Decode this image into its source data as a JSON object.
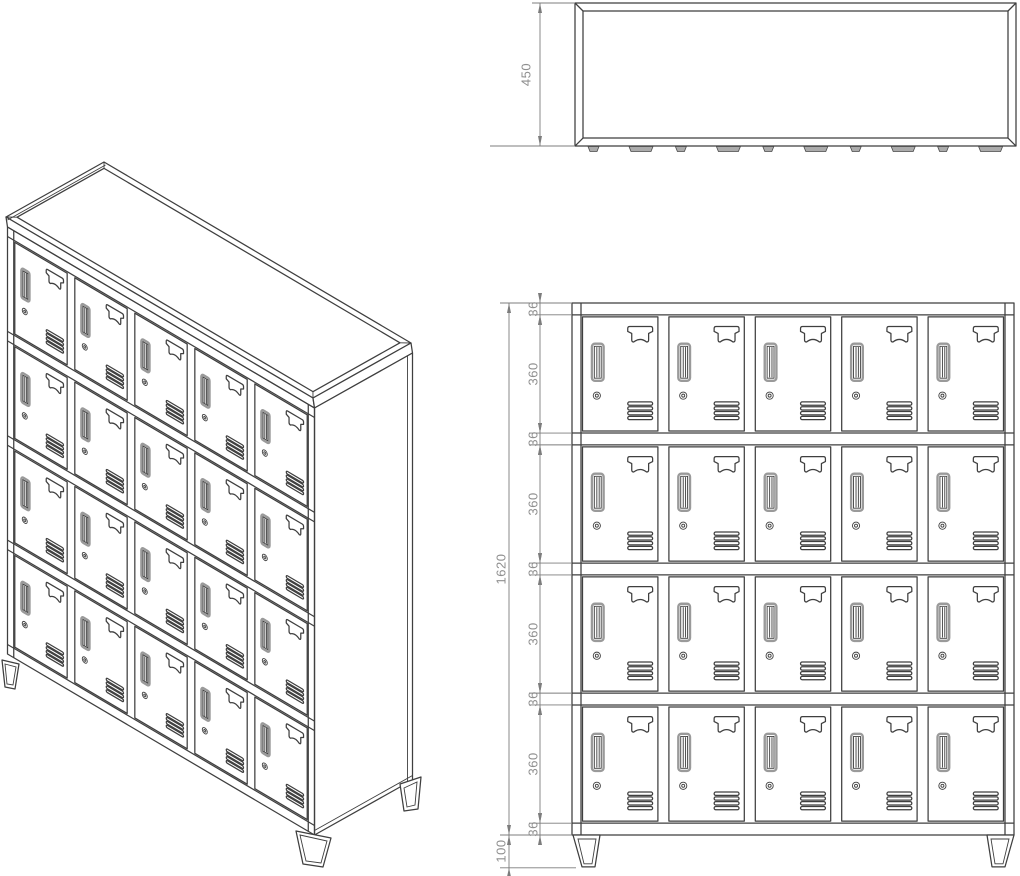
{
  "drawing": {
    "subject": "metal locker cabinet, 20 compartments, three-view technical drawing",
    "views": [
      "isometric-view",
      "top-view",
      "front-view"
    ],
    "line_color": "#3f3f3f",
    "dimension_color": "#7c7c7c",
    "dimension_text_color": "#8f8f8f",
    "hinge_tab_fill": "#ababab",
    "background": "#ffffff"
  },
  "cabinet": {
    "columns": 5,
    "rows": 4,
    "doors_total": 20,
    "door_features": [
      "name-card-holder",
      "vertical-handle",
      "cam-lock",
      "ventilation-slats"
    ],
    "feet": "trapezoid legs"
  },
  "dimensions": {
    "top_view_depth": "450",
    "front_total_height": "1620",
    "front_foot_height": "100",
    "front_chain": [
      "36",
      "360",
      "36",
      "360",
      "36",
      "360",
      "36",
      "360",
      "36"
    ]
  }
}
